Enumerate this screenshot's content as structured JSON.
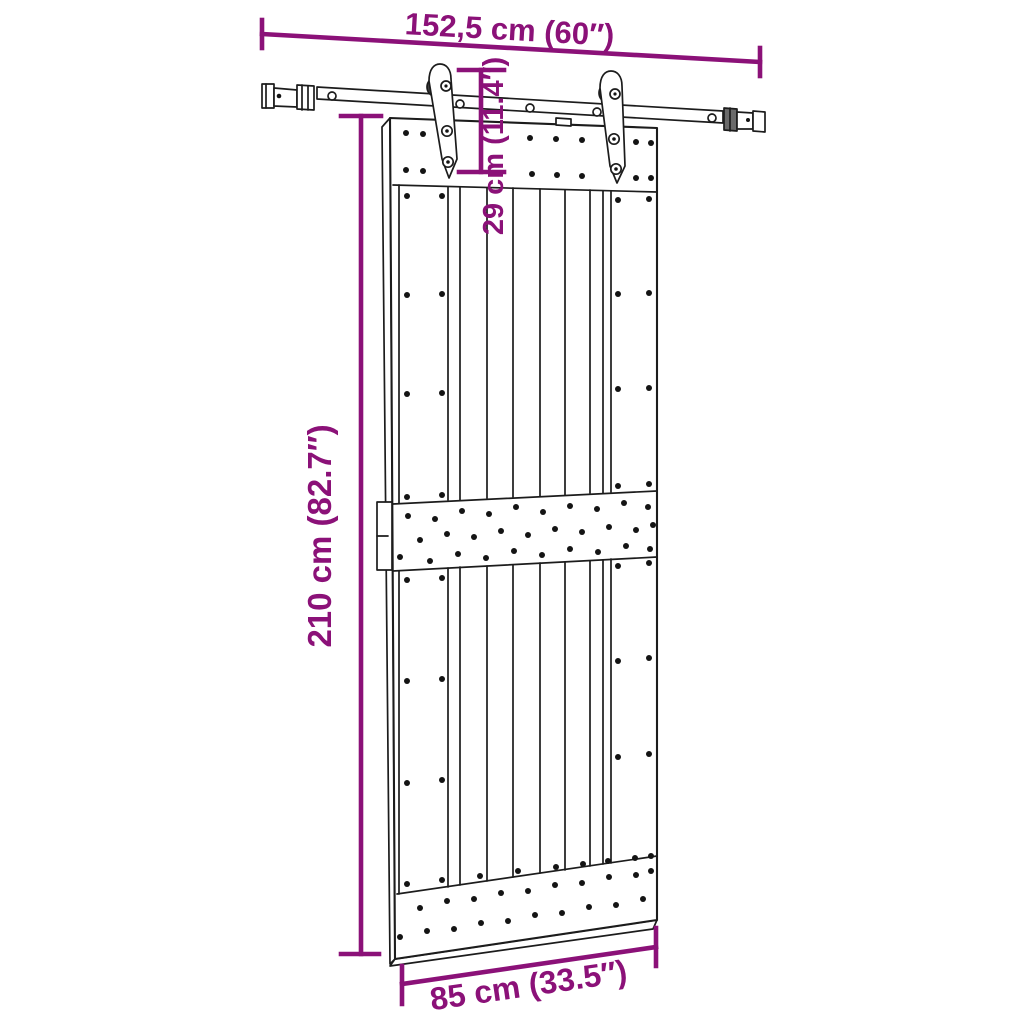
{
  "figure": {
    "labels": {
      "rail_length": "152,5 cm (60″)",
      "drop": "29 cm (11.4″)",
      "height": "210 cm (82.7″)",
      "width": "85 cm (33.5″)"
    },
    "colors": {
      "dimension": "#8B1178",
      "ink": "#1c1c1c",
      "background": "#ffffff"
    }
  }
}
